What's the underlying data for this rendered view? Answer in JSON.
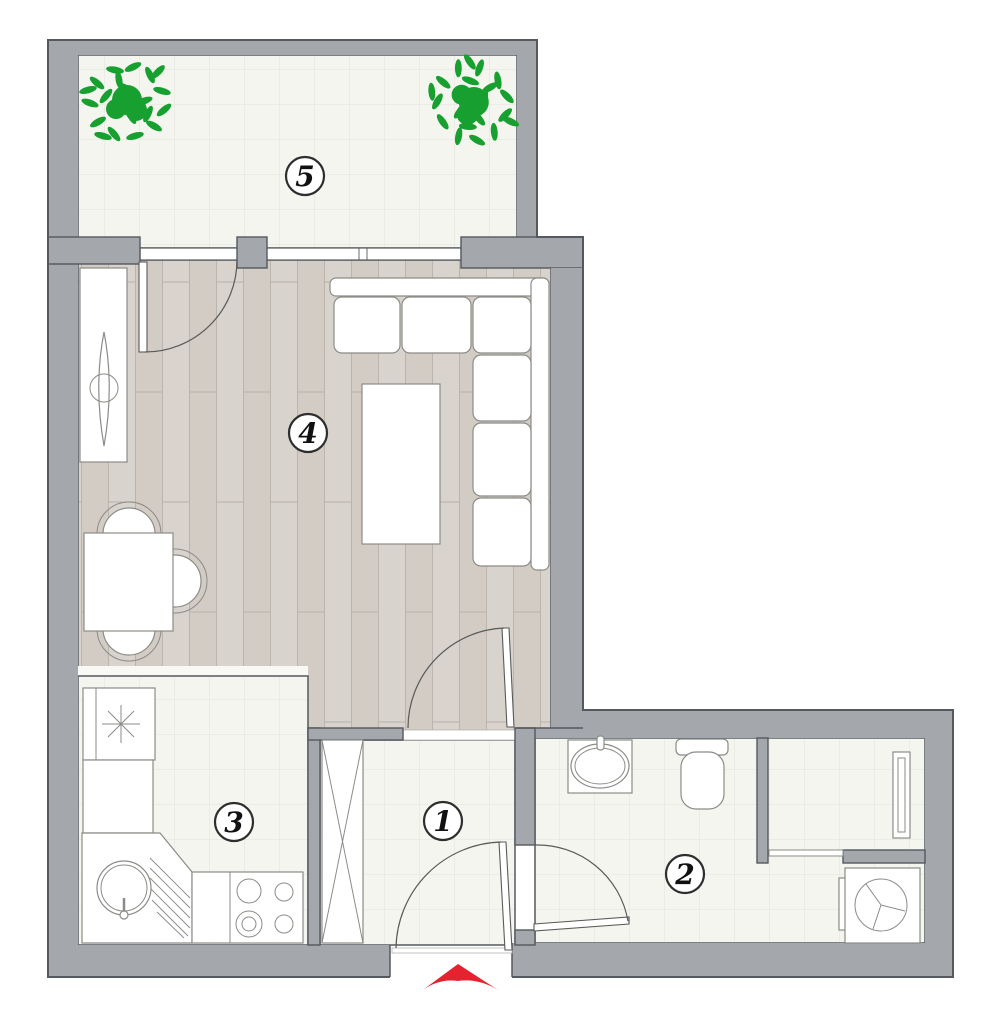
{
  "plan": {
    "rooms": [
      {
        "label": "1"
      },
      {
        "label": "2"
      },
      {
        "label": "3"
      },
      {
        "label": "4"
      },
      {
        "label": "5"
      }
    ],
    "colors": {
      "wall": "#a4a8ac",
      "outline": "#55595e",
      "tileBg": "#f5f5f0",
      "tileLine": "#e4e4db",
      "woodA": "#d9d3cd",
      "woodB": "#d2ccc5",
      "woodLine": "#b9b2aa",
      "white": "#ffffff",
      "furn": "#8b8b87",
      "door": "#5a5a58",
      "plant": "#17a02f",
      "arrow": "#e52330",
      "labelRing": "#2e2e2e",
      "labelText": "#111111"
    }
  }
}
